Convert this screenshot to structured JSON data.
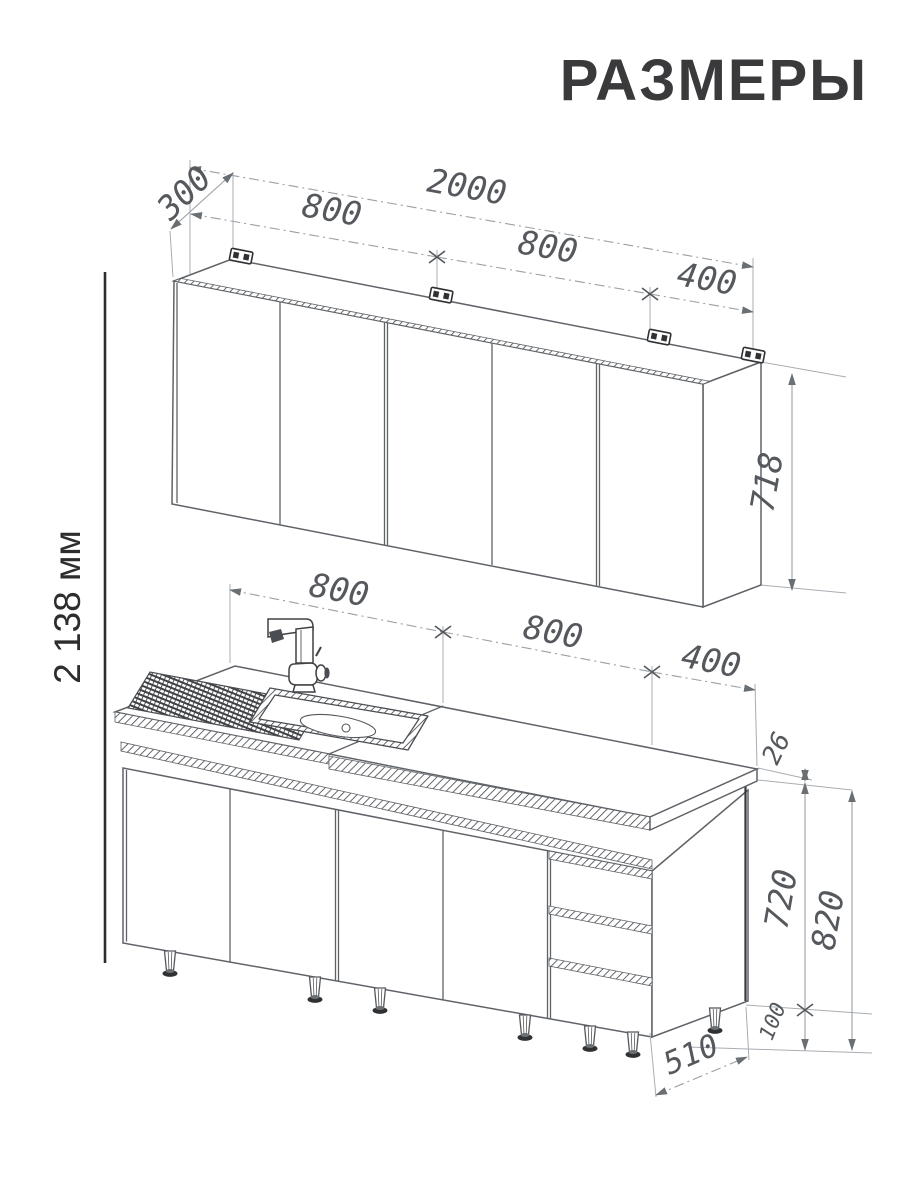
{
  "title": "РАЗМЕРЫ",
  "overall": {
    "height_label": "2 138 мм"
  },
  "wall_cabinets": {
    "total_width": "2000",
    "depth": "300",
    "section1": "800",
    "section2": "800",
    "section3": "400",
    "height": "718"
  },
  "base_cabinets": {
    "section1": "800",
    "section2": "800",
    "section3": "400",
    "countertop_thickness": "26",
    "carcass_height": "720",
    "total_height": "820",
    "leg_height": "100",
    "depth": "510"
  },
  "colors": {
    "drawing_line": "#5f6368",
    "dimension_line": "#9aa0a6",
    "dimension_text": "#55585c",
    "title_text": "#3a3a3c",
    "background": "#ffffff"
  }
}
